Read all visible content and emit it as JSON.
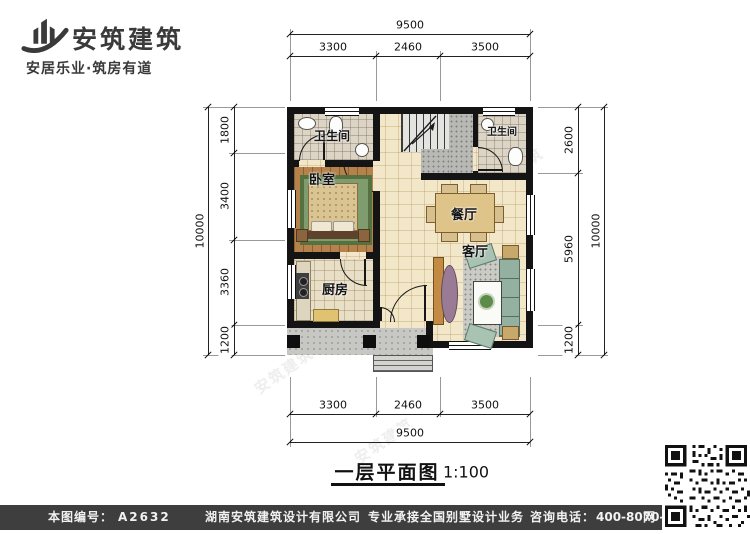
{
  "header": {
    "brand": "安筑建筑",
    "tagline": "安居乐业·筑房有道"
  },
  "plan": {
    "rooms": {
      "bathroom_left": "卫生间",
      "bathroom_right": "卫生间",
      "bedroom": "卧室",
      "kitchen": "厨房",
      "dining": "餐厅",
      "living": "客厅"
    }
  },
  "dimensions": {
    "top": {
      "overall": "9500",
      "segments": [
        "3300",
        "2460",
        "3500"
      ]
    },
    "bottom": {
      "overall": "9500",
      "segments": [
        "3300",
        "2460",
        "3500"
      ]
    },
    "left": {
      "overall": "10000",
      "segments": [
        "1800",
        "3400",
        "3360",
        "1200"
      ]
    },
    "right": {
      "overall": "10000",
      "segments": [
        "2600",
        "5960",
        "1200"
      ]
    }
  },
  "title_block": {
    "title": "一层平面图",
    "scale": "1:100"
  },
  "watermark": "安筑建筑",
  "footer": {
    "number_label": "本图编号：",
    "number": "A2632",
    "company": "湖南安筑建筑设计有限公司",
    "service": "专业承接全国别墅设计业务",
    "phone_label": "咨询电话：",
    "phone": "400-8070-511",
    "web": "网"
  },
  "colors": {
    "wall": "#141414",
    "floor_tile": "#f3e7c9",
    "wood_floor": "#b5824b",
    "footer_bg": "#3e3e3e"
  }
}
